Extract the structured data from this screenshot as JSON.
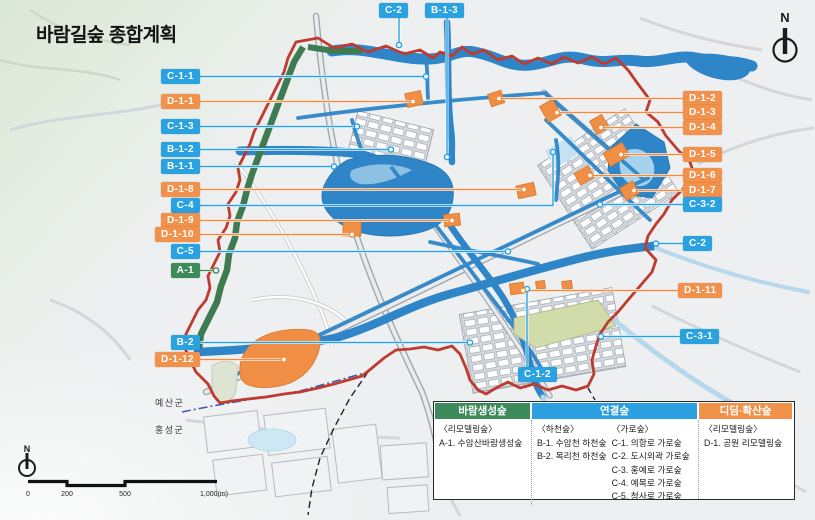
{
  "title": "바람길숲 종합계획",
  "compass": {
    "n": "N"
  },
  "scalebar": {
    "ticks": [
      "0",
      "200",
      "500",
      "1,000(m)"
    ]
  },
  "region_labels": [
    {
      "text": "예산군"
    },
    {
      "text": "홍성군"
    }
  ],
  "colors": {
    "tag_blue": "#29a2e1",
    "tag_orange": "#f2914c",
    "tag_green": "#3d8b5b",
    "boundary_red": "#bf3a2f",
    "water_blue": "#2e86c8",
    "forest_green": "#3f7b51",
    "park_orange": "#ef8e44"
  },
  "map_labels": [
    {
      "text": "C-2",
      "color": "blue"
    },
    {
      "text": "B-1-3",
      "color": "blue"
    },
    {
      "text": "C-1-1",
      "color": "blue"
    },
    {
      "text": "D-1-1",
      "color": "orange"
    },
    {
      "text": "C-1-3",
      "color": "blue"
    },
    {
      "text": "B-1-2",
      "color": "blue"
    },
    {
      "text": "B-1-1",
      "color": "blue"
    },
    {
      "text": "D-1-8",
      "color": "orange"
    },
    {
      "text": "C-4",
      "color": "blue"
    },
    {
      "text": "D-1-9",
      "color": "orange"
    },
    {
      "text": "D-1-10",
      "color": "orange"
    },
    {
      "text": "C-5",
      "color": "blue"
    },
    {
      "text": "A-1",
      "color": "green"
    },
    {
      "text": "B-2",
      "color": "blue"
    },
    {
      "text": "D-1-12",
      "color": "orange"
    },
    {
      "text": "D-1-2",
      "color": "orange"
    },
    {
      "text": "D-1-3",
      "color": "orange"
    },
    {
      "text": "D-1-4",
      "color": "orange"
    },
    {
      "text": "D-1-5",
      "color": "orange"
    },
    {
      "text": "D-1-6",
      "color": "orange"
    },
    {
      "text": "D-1-7",
      "color": "orange"
    },
    {
      "text": "C-3-2",
      "color": "blue"
    },
    {
      "text": "C-2",
      "color": "blue"
    },
    {
      "text": "D-1-11",
      "color": "orange"
    },
    {
      "text": "C-3-1",
      "color": "blue"
    },
    {
      "text": "C-1-2",
      "color": "blue"
    }
  ],
  "legend": {
    "columns": [
      {
        "header": "바람생성숲",
        "color": "#3d8b5b",
        "groups": [
          {
            "subtitle": "〈리모델링숲〉",
            "items": [
              "A-1. 수암산바람생성숲"
            ]
          }
        ]
      },
      {
        "header": "연결숲",
        "color": "#2b9fe0",
        "groups": [
          {
            "subtitle": "〈하천숲〉",
            "items": [
              "B-1. 수암천 하천숲",
              "B-2. 목리천 하천숲"
            ]
          },
          {
            "subtitle": "〈가로숲〉",
            "items": [
              "C-1. 의항로 가로숲",
              "C-2. 도시외곽 가로숲",
              "C-3. 홍예로 가로숲",
              "C-4. 예목로 가로숲",
              "C-5. 청사로 가로숲"
            ]
          }
        ]
      },
      {
        "header": "디딤·확산숲",
        "color": "#f0924a",
        "groups": [
          {
            "subtitle": "〈리모델링숲〉",
            "items": [
              "D-1. 공원 리모델링숲"
            ]
          }
        ]
      }
    ]
  }
}
